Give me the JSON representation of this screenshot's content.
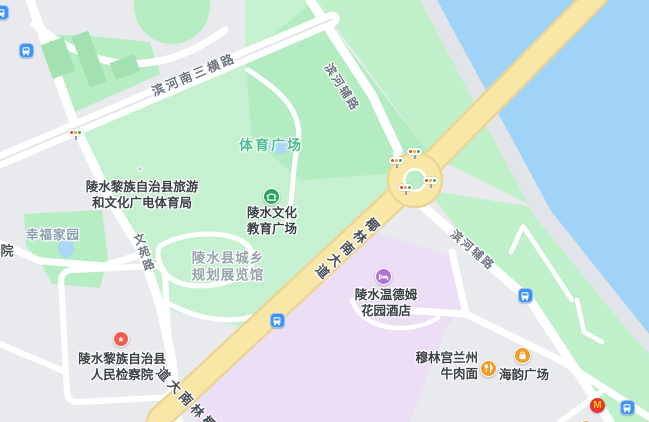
{
  "labels": {
    "roads": {
      "binhe_south_3rd": "滨河南三横路",
      "wenyuan_road": "文苑路",
      "yelin_south_ave": "椰林南大道",
      "binhe_side_road": "滨河辅路"
    },
    "areas": {
      "sports_plaza": "体育广场",
      "planning_hall": "陵水县城乡\n规划展览馆",
      "xingfu_homeland": "幸福家园",
      "partial_yuan": "院"
    },
    "pois": {
      "tourism_bureau": "陵水黎族自治县旅游\n和文化广电体育局",
      "culture_edu_square": "陵水文化\n教育广场",
      "procuratorate": "陵水黎族自治县\n人民检察院",
      "wyndham_hotel": "陵水温德姆\n花园酒店",
      "lanzhou_noodle": "穆林宫兰州\n牛肉面",
      "haiyun_plaza": "海韵广场",
      "mcdonalds_letter": "M",
      "star_glyph": "★"
    }
  },
  "icons": {
    "bus_stop": "bus-stop-icon",
    "traffic_light": "traffic-light-icon",
    "star_poi": "star-poi-icon",
    "pavilion": "pavilion-icon",
    "hotel_bed": "hotel-bed-icon",
    "restaurant": "restaurant-icon",
    "shopping_bag": "shopping-bag-icon",
    "mcdonalds": "mcdonalds-icon",
    "minor_poi_dot": "minor-poi-dot-icon"
  },
  "colors": {
    "water": "#9fd3f8",
    "river_bank": "#e1e5e9",
    "park_green": "#c6f1d0",
    "park_green_dark": "#b2ecc0",
    "building_green": "#a3e2b0",
    "major_road_fill": "#f9e7a8",
    "major_road_casing": "#ecd494",
    "city_block": "#e9eaee",
    "hotel_block_purple": "#ecdef4",
    "pond_blue": "#a9d8f3",
    "bus_blue": "#3f92f7",
    "poi_orange": "#f59a23",
    "poi_red": "#f25a4d",
    "mcdonalds_red": "#e8362d",
    "mcdonalds_yellow": "#fcc419",
    "hotel_purple": "#b470d6",
    "civic_green": "#2ba55b",
    "sports_label_green": "#4bbd90"
  }
}
